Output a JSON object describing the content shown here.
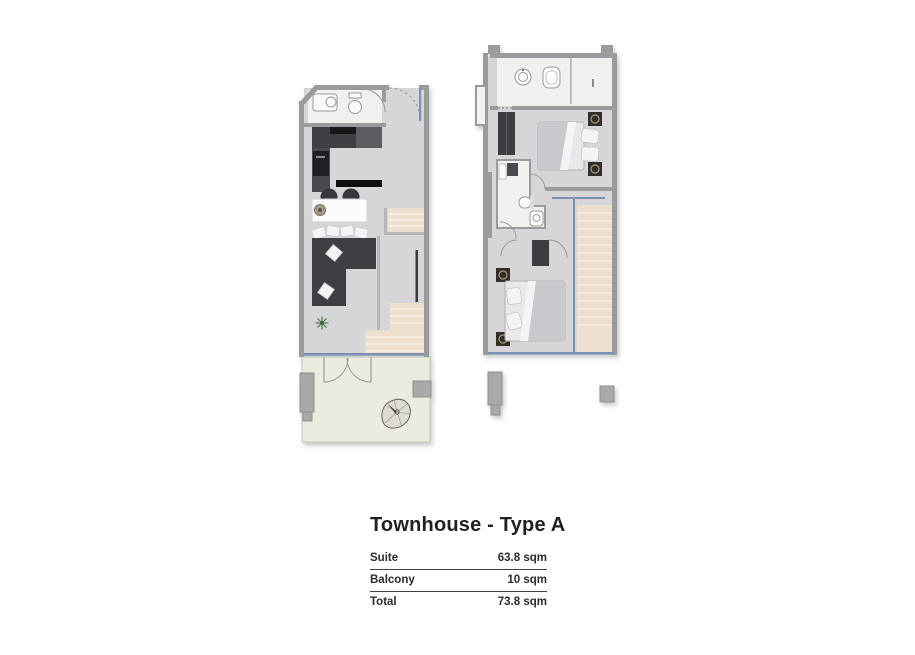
{
  "title": "Townhouse - Type A",
  "table": {
    "rows": [
      {
        "label": "Suite",
        "value": "63.8 sqm"
      },
      {
        "label": "Balcony",
        "value": "10 sqm"
      },
      {
        "label": "Total",
        "value": "73.8 sqm"
      }
    ]
  },
  "icons": {
    "compass_north": "teardrop north arrow on balcony",
    "plant": "small green plant in living room"
  },
  "colors": {
    "wall": "#9b9b9d",
    "wall_light": "#b5b5b8",
    "floor": "#d6d6d9",
    "room_white": "#f0f0ef",
    "furniture_dark": "#3c3c41",
    "stairs": "#ecdfcd",
    "stairs_step": "#f8f1e7",
    "balcony_floor": "#ebece0",
    "window_blue": "#7b90b3",
    "fixture_white": "#fbfbfa",
    "planter_gray": "#a9a9aa",
    "text": "#231f20"
  }
}
